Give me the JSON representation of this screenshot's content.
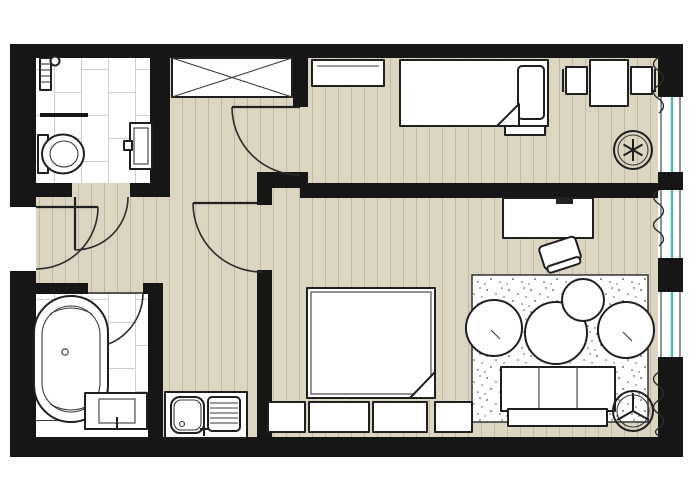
{
  "canvas": {
    "width": 700,
    "height": 478
  },
  "colors": {
    "wall": "#161616",
    "outline": "#1f1f1f",
    "floor_wood": "#dbd5c2",
    "floor_plank_line": "#bfb9a6",
    "tile": "#ffffff",
    "tile_line": "#cfcfcf",
    "rug_base": "#ffffff",
    "rug_dot": "#4a4a4a",
    "furniture_fill": "#ffffff",
    "window_glass": "#57b8b8",
    "background": "#ffffff"
  },
  "plan": {
    "type": "apartment-floor-plan",
    "rooms": [
      {
        "name": "bathroom-upper-left",
        "floor": "tile",
        "objects": [
          "towel-radiator",
          "partition-stub",
          "toilet",
          "washbasin",
          "door-swing"
        ]
      },
      {
        "name": "hallway",
        "floor": "wood",
        "objects": [
          "wardrobe-crossed",
          "entry-door-swing"
        ]
      },
      {
        "name": "bedroom-upper-right",
        "floor": "wood",
        "objects": [
          "dresser",
          "single-bed",
          "pillow",
          "blanket-fold",
          "bedside-bench",
          "dining-table",
          "chair-left",
          "chair-right",
          "curtain",
          "ceiling-fan-asterisk",
          "door-swing"
        ]
      },
      {
        "name": "bedroom-lower-middle",
        "floor": "wood",
        "objects": [
          "double-bed",
          "blanket-fold",
          "nightstand-left",
          "pillow-left",
          "pillow-right",
          "nightstand-right",
          "door-swing"
        ]
      },
      {
        "name": "living-study-lower-right",
        "floor": "wood",
        "objects": [
          "desk",
          "laptop",
          "desk-chair",
          "speckled-rug",
          "armchair-left",
          "armchair-right",
          "coffee-table",
          "side-table",
          "sofa",
          "curtain",
          "curtain",
          "ceiling-fan-three-blade"
        ]
      },
      {
        "name": "bathroom-lower-left",
        "floor": "tile",
        "objects": [
          "freestanding-bathtub",
          "vanity-basin",
          "counter-step",
          "door-swing"
        ]
      },
      {
        "name": "kitchen-nook",
        "floor": "wood",
        "objects": [
          "sink-unit-bowl",
          "sink-unit-drainboard",
          "faucet"
        ]
      }
    ],
    "openings": {
      "doors": 5,
      "windows_right_wall": 3,
      "entry_door_left_wall": 1
    },
    "symbols": [
      "door-swing-arc",
      "window-glazing-teal",
      "curtain-squiggle",
      "ceiling-fan-asterisk",
      "ceiling-fan-three-blade"
    ]
  }
}
